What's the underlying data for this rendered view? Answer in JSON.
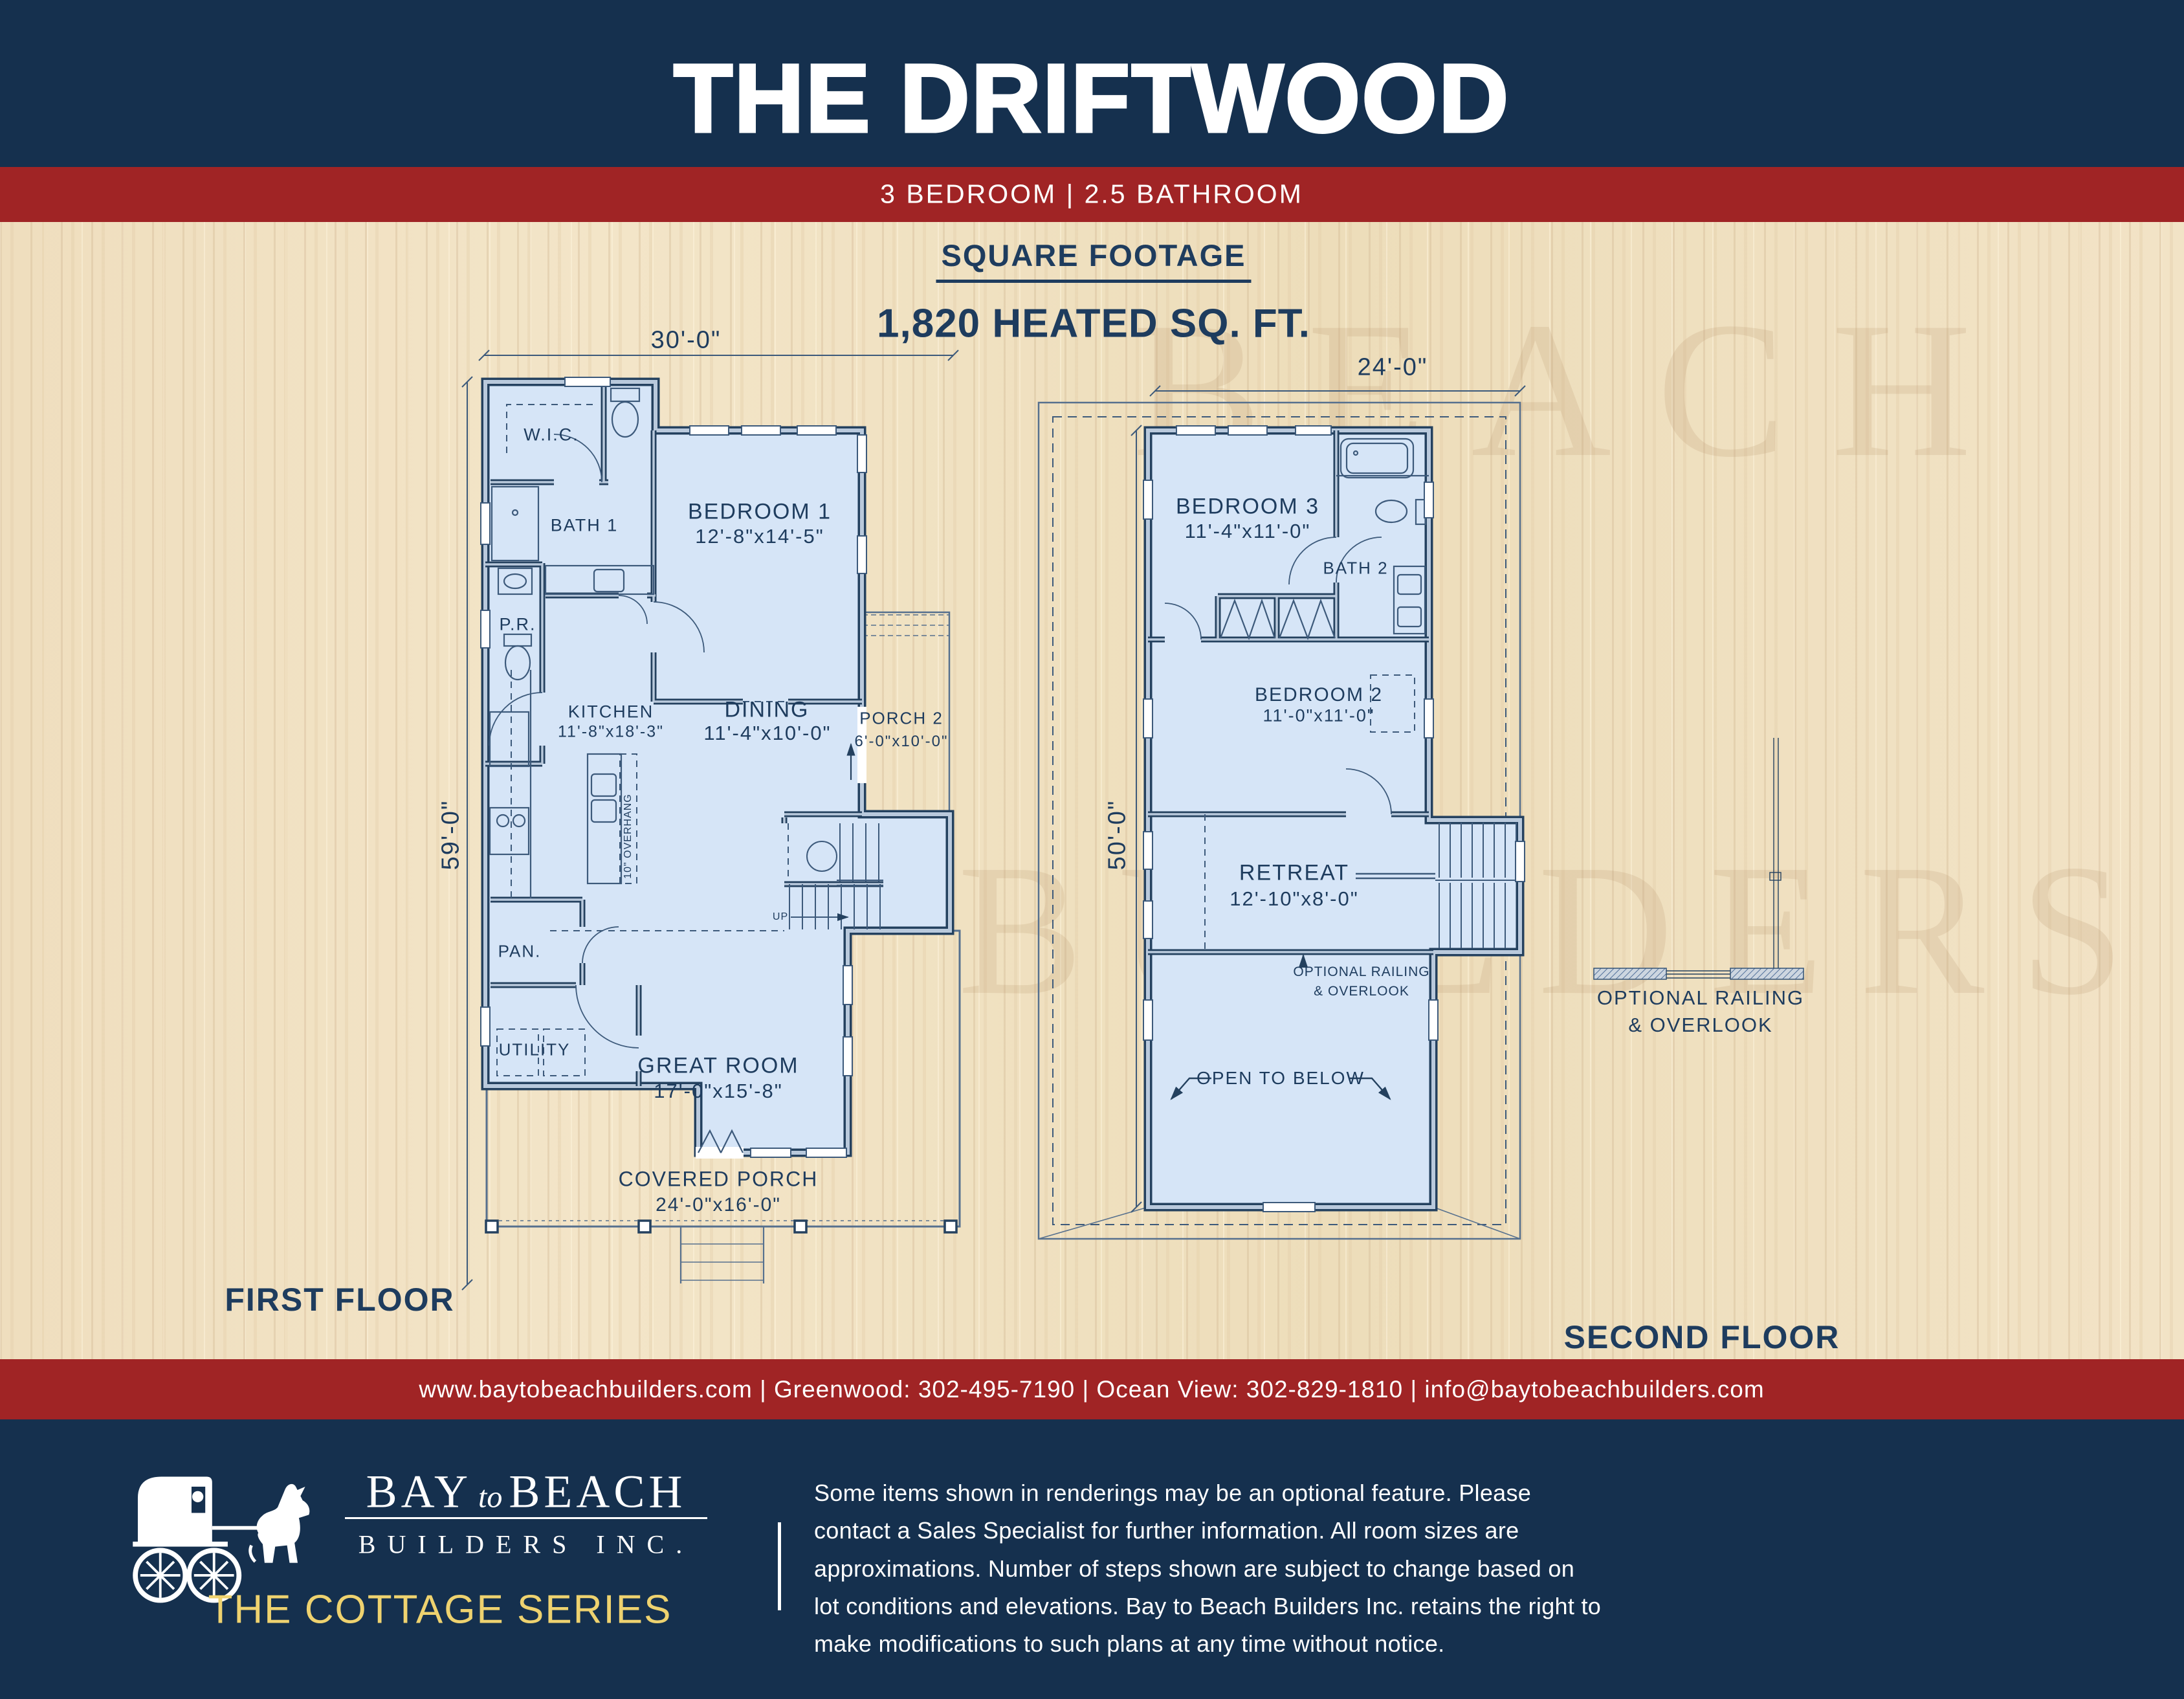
{
  "header": {
    "title": "THE DRIFTWOOD",
    "subtitle": "3 BEDROOM | 2.5 BATHROOM"
  },
  "square_footage": {
    "heading": "SQUARE FOOTAGE",
    "value": "1,820 HEATED SQ. FT."
  },
  "first_floor": {
    "label": "FIRST FLOOR",
    "width_dim": "30'-0\"",
    "height_dim": "59'-0\"",
    "rooms": {
      "wic": "W.I.C.",
      "bath1": "BATH 1",
      "pr": "P.R.",
      "bedroom1": "BEDROOM 1",
      "bedroom1_size": "12'-8\"x14'-5\"",
      "kitchen": "KITCHEN",
      "kitchen_size": "11'-8\"x18'-3\"",
      "dining": "DINING",
      "dining_size": "11'-4\"x10'-0\"",
      "porch2": "PORCH 2",
      "porch2_size": "6'-0\"x10'-0\"",
      "pan": "PAN.",
      "utility": "UTILITY",
      "great": "GREAT ROOM",
      "great_size": "17'-0\"x15'-8\"",
      "porch": "COVERED PORCH",
      "porch_size": "24'-0\"x16'-0\"",
      "up": "UP",
      "overhang": "10\" OVERHANG"
    }
  },
  "second_floor": {
    "label": "SECOND FLOOR",
    "width_dim": "24'-0\"",
    "height_dim": "50'-0\"",
    "rooms": {
      "bedroom3": "BEDROOM 3",
      "bedroom3_size": "11'-4\"x11'-0\"",
      "bath2": "BATH 2",
      "bedroom2": "BEDROOM 2",
      "bedroom2_size": "11'-0\"x11'-0\"",
      "retreat": "RETREAT",
      "retreat_size": "12'-10\"x8'-0\"",
      "railing_note_1": "OPTIONAL RAILING",
      "railing_note_2": "& OVERLOOK",
      "open_below": "OPEN TO BELOW"
    }
  },
  "legend": {
    "railing_1": "OPTIONAL RAILING",
    "railing_2": "& OVERLOOK"
  },
  "watermark": {
    "line1": "BEACH",
    "line2": "BUILDERS INC"
  },
  "contact_bar": "www.baytobeachbuilders.com | Greenwood: 302-495-7190 | Ocean View: 302-829-1810 | info@baytobeachbuilders.com",
  "footer": {
    "logo_bay": "BAY",
    "logo_to": "to",
    "logo_beach": "BEACH",
    "logo_sub": "BUILDERS INC.",
    "series": "THE COTTAGE SERIES",
    "disclaimer": "Some items shown in renderings may be an optional feature. Please contact a Sales Specialist for further information. All room sizes are approximations. Number of steps shown are subject to change based on lot conditions and elevations. Bay to Beach Builders Inc. retains the right to make modifications to such plans at any time without notice."
  },
  "colors": {
    "navy": "#15304e",
    "red": "#a02425",
    "gold": "#eed26f",
    "plan_fill": "#d6e5f7",
    "wall": "#24415f",
    "wood": "#f0dfc0"
  }
}
